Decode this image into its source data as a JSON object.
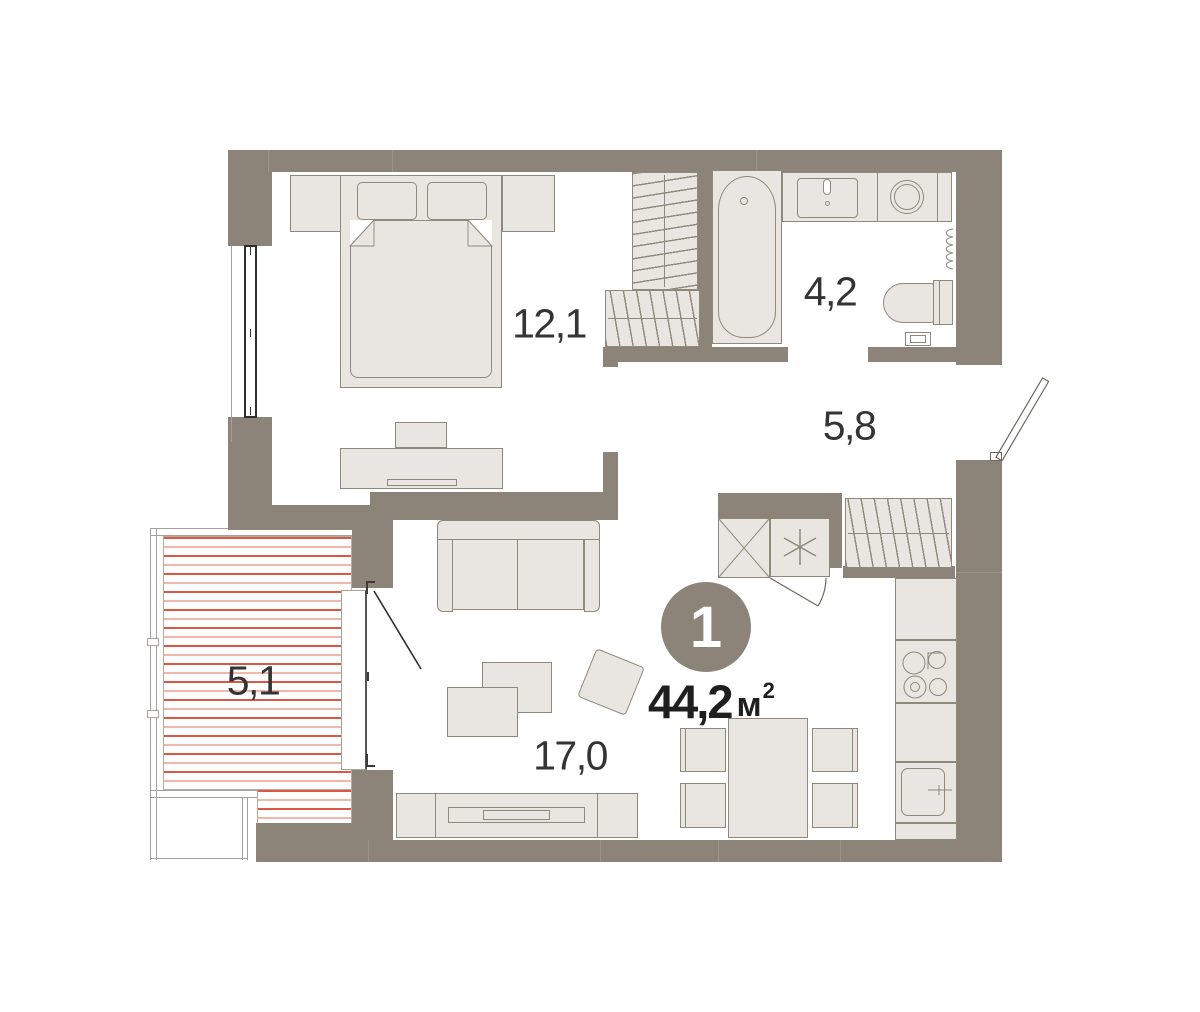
{
  "apartment": {
    "badge_number": "1",
    "total_area": {
      "value": "44,2",
      "unit": "м",
      "superscript": "2"
    },
    "rooms": {
      "bedroom": {
        "area": "12,1"
      },
      "bathroom": {
        "area": "4,2"
      },
      "hallway": {
        "area": "5,8"
      },
      "balcony": {
        "area": "5,1"
      },
      "living_kitchen": {
        "area": "17,0"
      }
    }
  },
  "colors": {
    "wall": "#8c8478",
    "wall_seam": "#9c9488",
    "furn_fill": "#e9e6e1",
    "furn_stroke": "#8f887b",
    "hatch_strong": "#dd5742",
    "hatch_light": "#f2b7ab",
    "hatch_border": "#b3aca3",
    "glaze": "#a7a099",
    "text": "#343434",
    "area_text": "#1f1f1f",
    "badge_bg": "#8c8478",
    "badge_text": "#ffffff",
    "door_line": "#6e675e",
    "window_frame": "#2e2e2e"
  }
}
